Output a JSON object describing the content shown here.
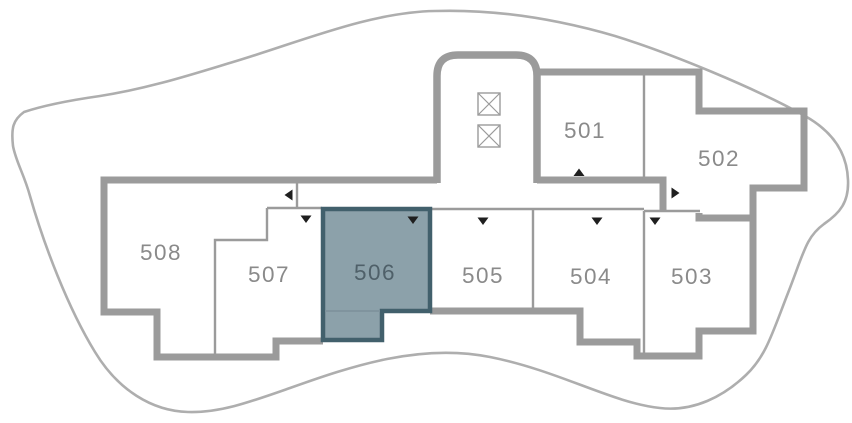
{
  "floorplan": {
    "selected_unit": "506",
    "units": [
      {
        "id": "501",
        "label": "501",
        "selected": false,
        "entry_arrow": "up"
      },
      {
        "id": "502",
        "label": "502",
        "selected": false,
        "entry_arrow": "right"
      },
      {
        "id": "503",
        "label": "503",
        "selected": false,
        "entry_arrow": "down"
      },
      {
        "id": "504",
        "label": "504",
        "selected": false,
        "entry_arrow": "down"
      },
      {
        "id": "505",
        "label": "505",
        "selected": false,
        "entry_arrow": "down"
      },
      {
        "id": "506",
        "label": "506",
        "selected": true,
        "entry_arrow": "down"
      },
      {
        "id": "507",
        "label": "507",
        "selected": false,
        "entry_arrow": "down"
      },
      {
        "id": "508",
        "label": "508",
        "selected": false,
        "entry_arrow": "left"
      }
    ],
    "elevators": {
      "count": 2,
      "symbol": "crossed-box"
    }
  },
  "colors": {
    "background": "#ffffff",
    "boundary": "#aeaeae",
    "wall": "#9b9b9b",
    "divider": "#9b9b9b",
    "elevator_stroke": "#9b9b9b",
    "label": "#8a8a8a",
    "arrow": "#1f1f1f",
    "selected_fill": "#8ca1aa",
    "selected_stroke": "#42606c",
    "selected_label": "#4f6069",
    "selected_inner_line": "#7e939d"
  }
}
